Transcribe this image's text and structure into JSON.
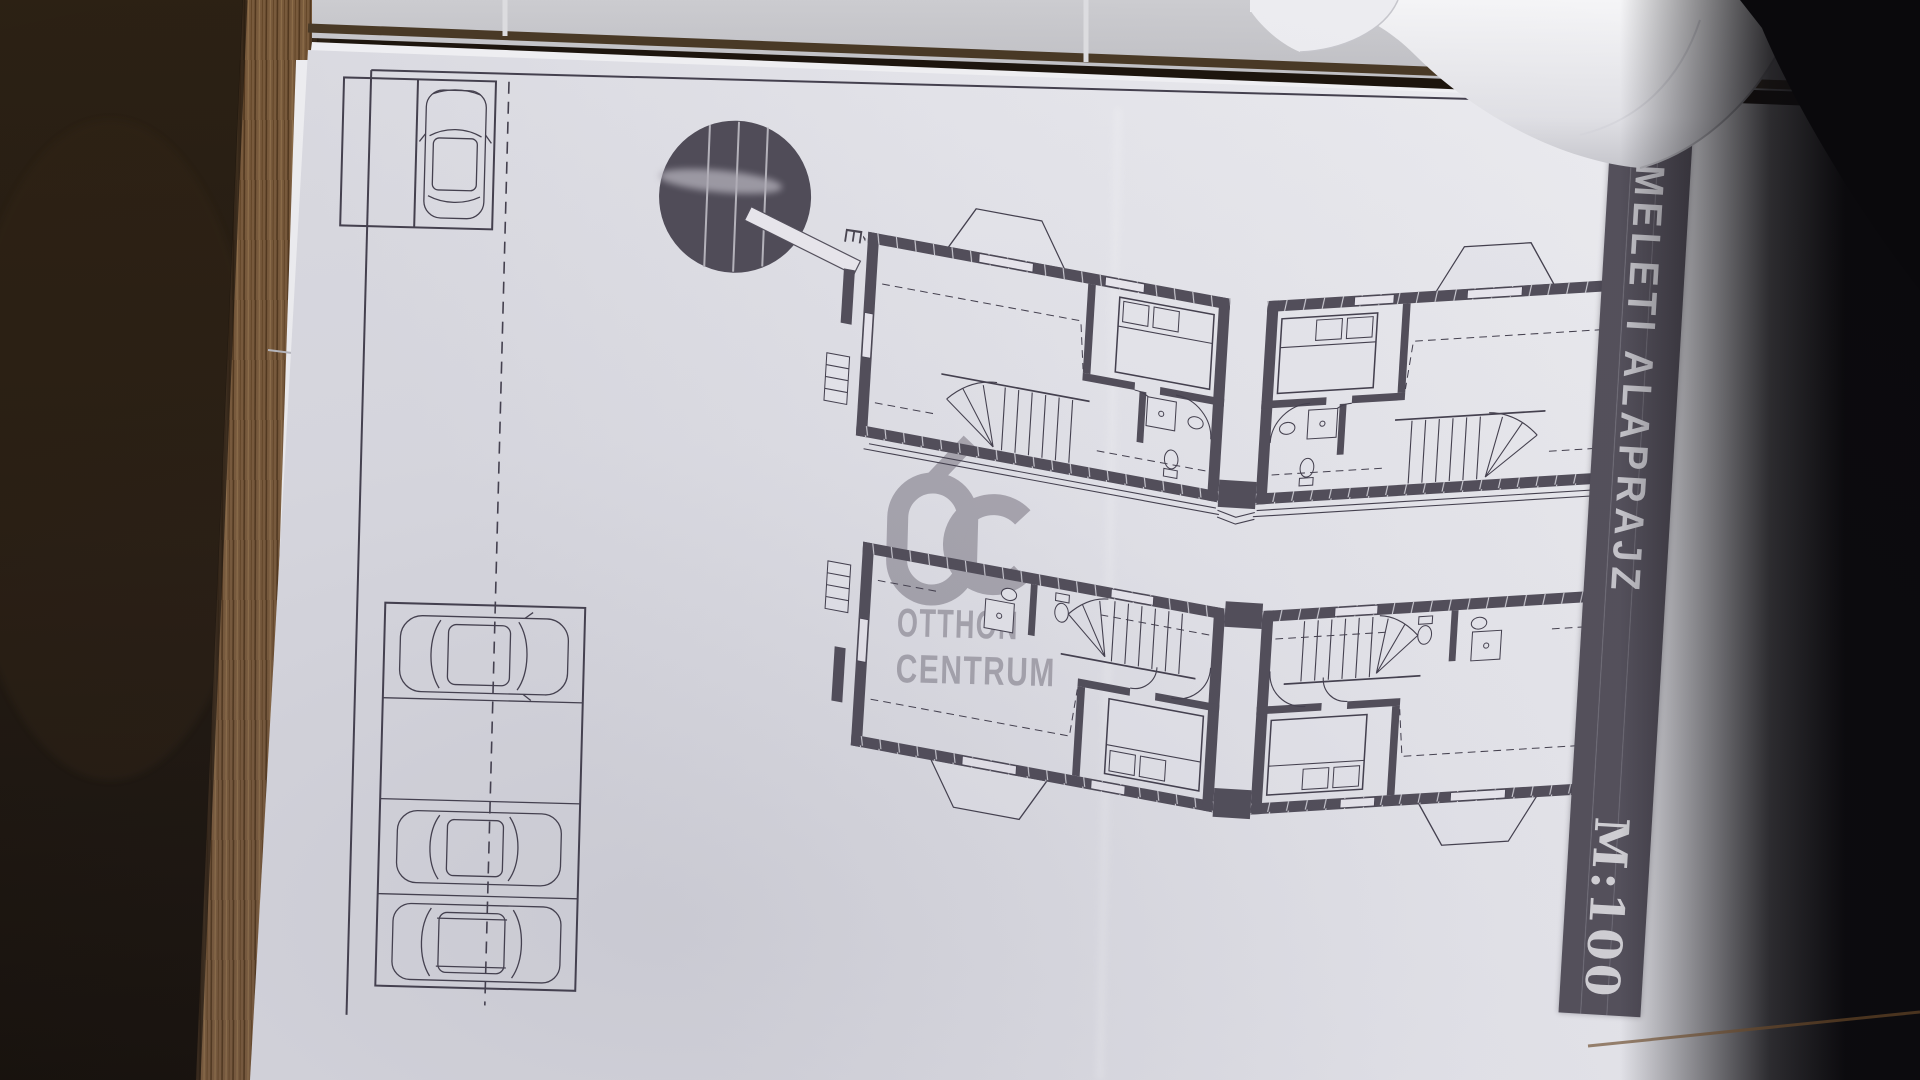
{
  "sheet": {
    "banner": {
      "title": "EMELETI ALAPRAJZ",
      "scale_label": "M:100"
    },
    "watermark": {
      "line1": "OTTHON",
      "line2": "CENTRUM"
    },
    "north_label": "É"
  },
  "colors": {
    "banner_bg": "#55515c",
    "banner_text": "#c9c8ce",
    "watermark": "#a19ea8",
    "ink": "#45414f",
    "wall": "#534f5b",
    "paper": "#e6e6ec",
    "tile": "#c7c7cb",
    "wood": "#7a5b3c"
  }
}
